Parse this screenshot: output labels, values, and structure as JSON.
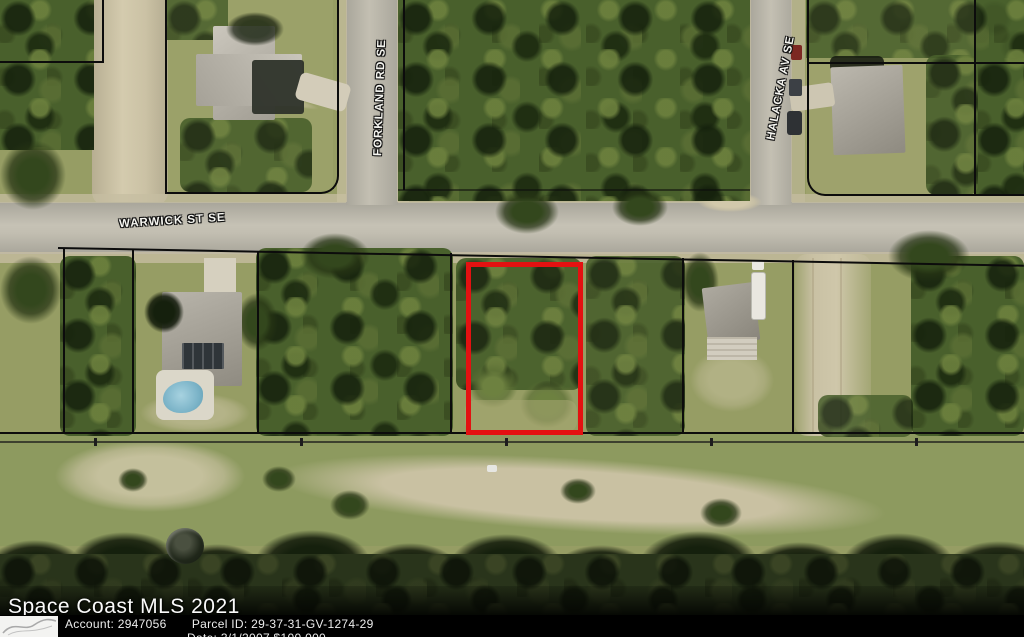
{
  "map": {
    "street_labels": [
      {
        "name": "WARWICK ST SE"
      },
      {
        "name": "FORKLAND RD SE"
      },
      {
        "name": "HALACKA AV SE"
      }
    ],
    "highlight_color": "#e31111"
  },
  "watermark": {
    "text": "Space Coast MLS 2021"
  },
  "info_bar": {
    "account_label": "Account:",
    "account_value": "2947056",
    "parcel_label": "Parcel ID:",
    "parcel_value": "29-37-31-GV-1274-29",
    "partial_bottom_line": "Date: 3/1/2007 $100,000"
  }
}
